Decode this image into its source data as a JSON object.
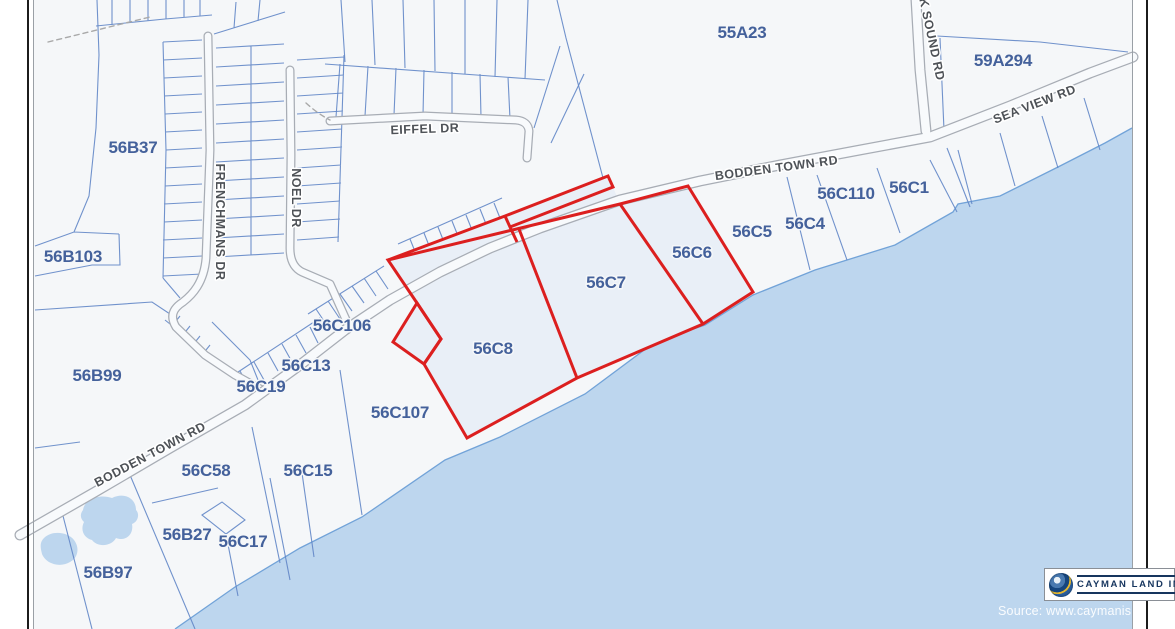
{
  "map": {
    "kind": "cadastral-parcel-map",
    "highlight_color": "#dc1f1f",
    "sea_color": "#bdd6ee",
    "parcel_line_color": "#6286c6",
    "label_color": "#44619b",
    "parcels": [
      {
        "id": "55A23"
      },
      {
        "id": "59A294"
      },
      {
        "id": "56B37"
      },
      {
        "id": "56B103"
      },
      {
        "id": "56B99"
      },
      {
        "id": "56B97"
      },
      {
        "id": "56B27"
      },
      {
        "id": "56C58"
      },
      {
        "id": "56C17"
      },
      {
        "id": "56C15"
      },
      {
        "id": "56C19"
      },
      {
        "id": "56C13"
      },
      {
        "id": "56C106"
      },
      {
        "id": "56C107"
      },
      {
        "id": "56C8",
        "highlighted": true
      },
      {
        "id": "56C7",
        "highlighted": true
      },
      {
        "id": "56C6",
        "highlighted": true
      },
      {
        "id": "56C5"
      },
      {
        "id": "56C4"
      },
      {
        "id": "56C110"
      },
      {
        "id": "56C1"
      }
    ],
    "roads": [
      {
        "name": "BODDEN TOWN RD"
      },
      {
        "name": "BODDEN TOWN RD"
      },
      {
        "name": "EIFFEL DR"
      },
      {
        "name": "FRENCHMANS DR"
      },
      {
        "name": "NOEL DR"
      },
      {
        "name": "SEA VIEW RD"
      },
      {
        "name": "K SOUND RD"
      }
    ]
  },
  "branding": {
    "logo_text": "CAYMAN LAND INFO",
    "source_text": "Source: www.caymanislandsland"
  }
}
